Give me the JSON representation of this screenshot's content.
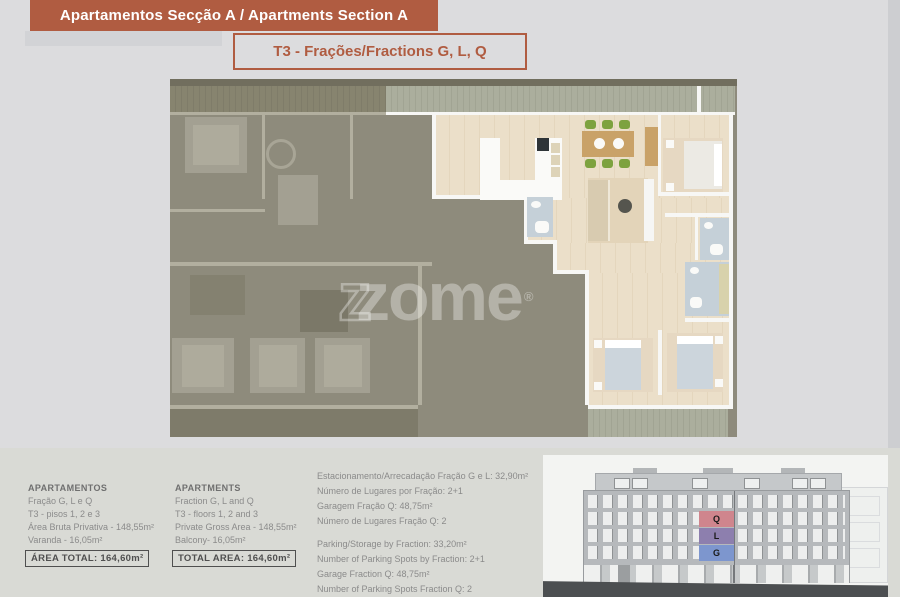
{
  "colors": {
    "accent_terracotta": "#b05c41",
    "page_background": "#dcdcde",
    "unit_q_highlight": "#cf858d",
    "unit_l_highlight": "#8d7fae",
    "unit_g_highlight": "#7d96ce"
  },
  "header": {
    "title": "Apartamentos Secção A / Apartments Section A",
    "subtitle": "T3 - Frações/Fractions G, L, Q"
  },
  "watermark": {
    "logo_prefix": "z",
    "text": "zome",
    "registered": "®"
  },
  "apartments_pt": {
    "heading": "APARTAMENTOS",
    "lines": [
      "Fração G, L e Q",
      "T3 - pisos 1, 2 e 3",
      "Área Bruta Privativa - 148,55m²",
      "Varanda - 16,05m²"
    ],
    "total": "ÁREA TOTAL: 164,60m²"
  },
  "apartments_en": {
    "heading": "APARTMENTS",
    "lines": [
      "Fraction G, L and Q",
      "T3 - floors 1, 2 and 3",
      "Private Gross Area - 148,55m²",
      "Balcony- 16,05m²"
    ],
    "total": "TOTAL AREA: 164,60m²"
  },
  "parking": {
    "pt_lines": [
      "Estacionamento/Arrecadação Fração G e L: 32,90m²",
      "Número de Lugares por Fração: 2+1",
      "Garagem Fração Q: 48,75m²",
      "Número de Lugares Fração Q: 2"
    ],
    "en_lines": [
      "Parking/Storage by Fraction: 33,20m²",
      "Number of Parking Spots by Fraction: 2+1",
      "Garage Fraction Q: 48,75m²",
      "Number of Parking Spots Fraction Q: 2"
    ]
  },
  "elevation": {
    "units": [
      {
        "label": "Q",
        "color": "#cf858d"
      },
      {
        "label": "L",
        "color": "#8d7fae"
      },
      {
        "label": "G",
        "color": "#7d96ce"
      }
    ]
  }
}
